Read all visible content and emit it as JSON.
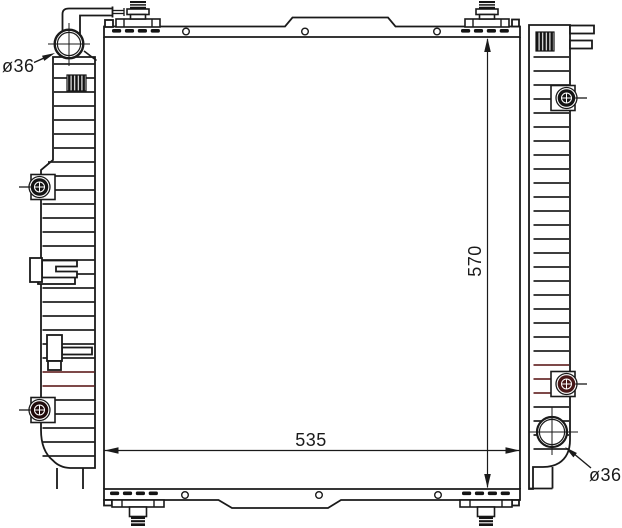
{
  "drawing": {
    "type": "technical-drawing",
    "subject": "radiator",
    "labels": {
      "width_dim": "535",
      "height_dim": "570",
      "top_left_port_dia": "ø36",
      "bottom_right_port_dia": "ø36"
    },
    "colors": {
      "line": "#1a1a1a",
      "background": "#ffffff",
      "accent_maroon": "#6b2f2f",
      "fitting_dark": "#471717"
    }
  }
}
